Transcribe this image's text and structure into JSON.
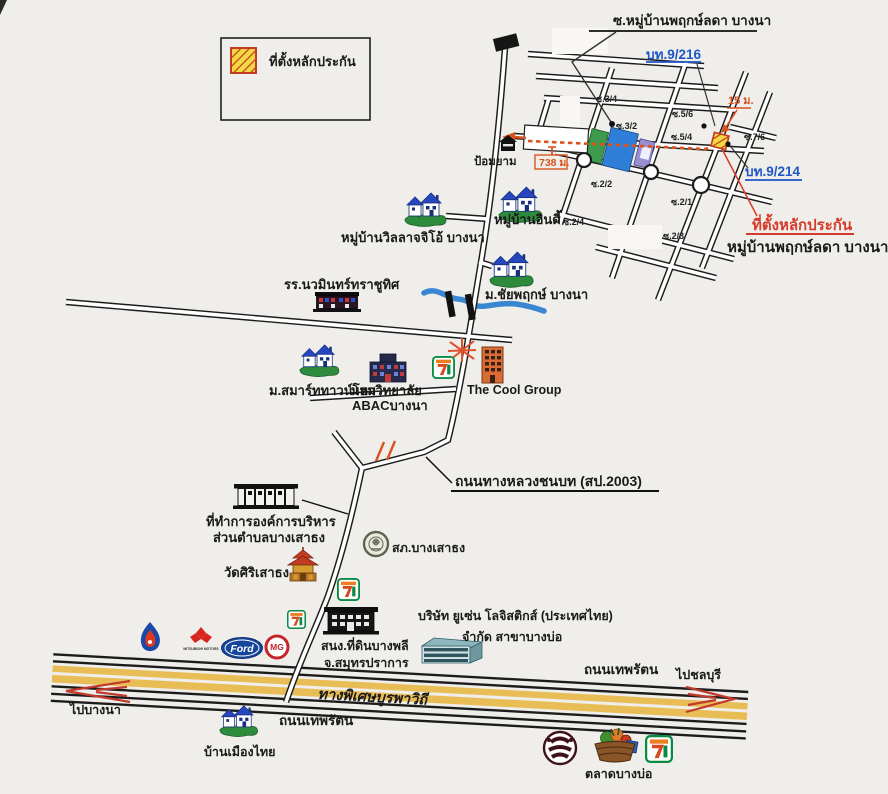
{
  "legend": {
    "label": "ที่ตั้งหลักประกัน"
  },
  "grid_area": {
    "soi_entry_title": "ซ.หมู่บ้านพฤกษ์ลดา บางนา",
    "route_bt_9_216": "บท.9/216",
    "route_bt_9_214": "บท.9/214",
    "dist_15m": "15 ม.",
    "dist_738m": "738 ม.",
    "guard_post": "ป้อมยาม",
    "soi_3_4": "ซ.3/4",
    "soi_3_2": "ซ.3/2",
    "soi_5_6": "ซ.5/6",
    "soi_5_4": "ซ.5/4",
    "soi_7_6": "ซ.7/6",
    "soi_2_2": "ซ.2/2",
    "soi_2_1": "ซ.2/1",
    "soi_2_4": "ซ.2/4",
    "soi_2_3": "ซ.2/3",
    "collateral_site": "ที่ตั้งหลักประกัน",
    "village_name": "หมู่บ้านพฤกษ์ลดา บางนา"
  },
  "landmarks": {
    "villaggio": "หมู่บ้านวิลลาจจิโอ้ บางนา",
    "indy": "หมู่บ้านอินดี้",
    "chaiyapruek": "ม.ชัยพฤกษ์ บางนา",
    "school": "รร.นวมินทร์ทราชูทิศ",
    "smart_townhome": "ม.สมาร์ททาวน์โฮม",
    "university_line1": "มหาวิทยาลัย",
    "university_line2": "ABACบางนา",
    "cool_group": "The Cool Group",
    "district_office_line1": "ที่ทำการองค์การบริหาร",
    "district_office_line2": "ส่วนตำบลบางเสาธง",
    "police_station": "สภ.บางเสาธง",
    "temple": "วัดศิริเสาธง",
    "land_office_line1": "สนง.ที่ดินบางพลี",
    "land_office_line2": "จ.สมุทรปราการ",
    "yusen_line1": "บริษัท ยูเซ่น โลจิสติกส์ (ประเทศไทย)",
    "yusen_line2": "จำกัด สาขาบางบ่อ",
    "baan_muang_thai": "บ้านเมืองไทย",
    "market": "ตลาดบางบ่อ"
  },
  "roads": {
    "rural_highway": "ถนนทางหลวงชนบท (สป.2003)",
    "thepharat_east": "ถนนเทพรัตน",
    "thepharat_west": "ถนนเทพรัตน",
    "expressway": "ทางพิเศษบูรพาวิถี",
    "to_bangna": "ไปบางนา",
    "to_chonburi": "ไปชลบุรี"
  },
  "brands": {
    "ford": "Ford",
    "mg": "MG",
    "mitsubishi": "MITSUBISHI MOTORS"
  },
  "colors": {
    "accent_orange": "#d9531e",
    "label_red": "#d63a2a",
    "label_blue": "#1e56c8",
    "expressway_yellow": "#e9bd55",
    "canal_blue": "#2e7fd0",
    "marker_yellow": "#f2d943",
    "marker_hatch_red": "#c23b22"
  }
}
